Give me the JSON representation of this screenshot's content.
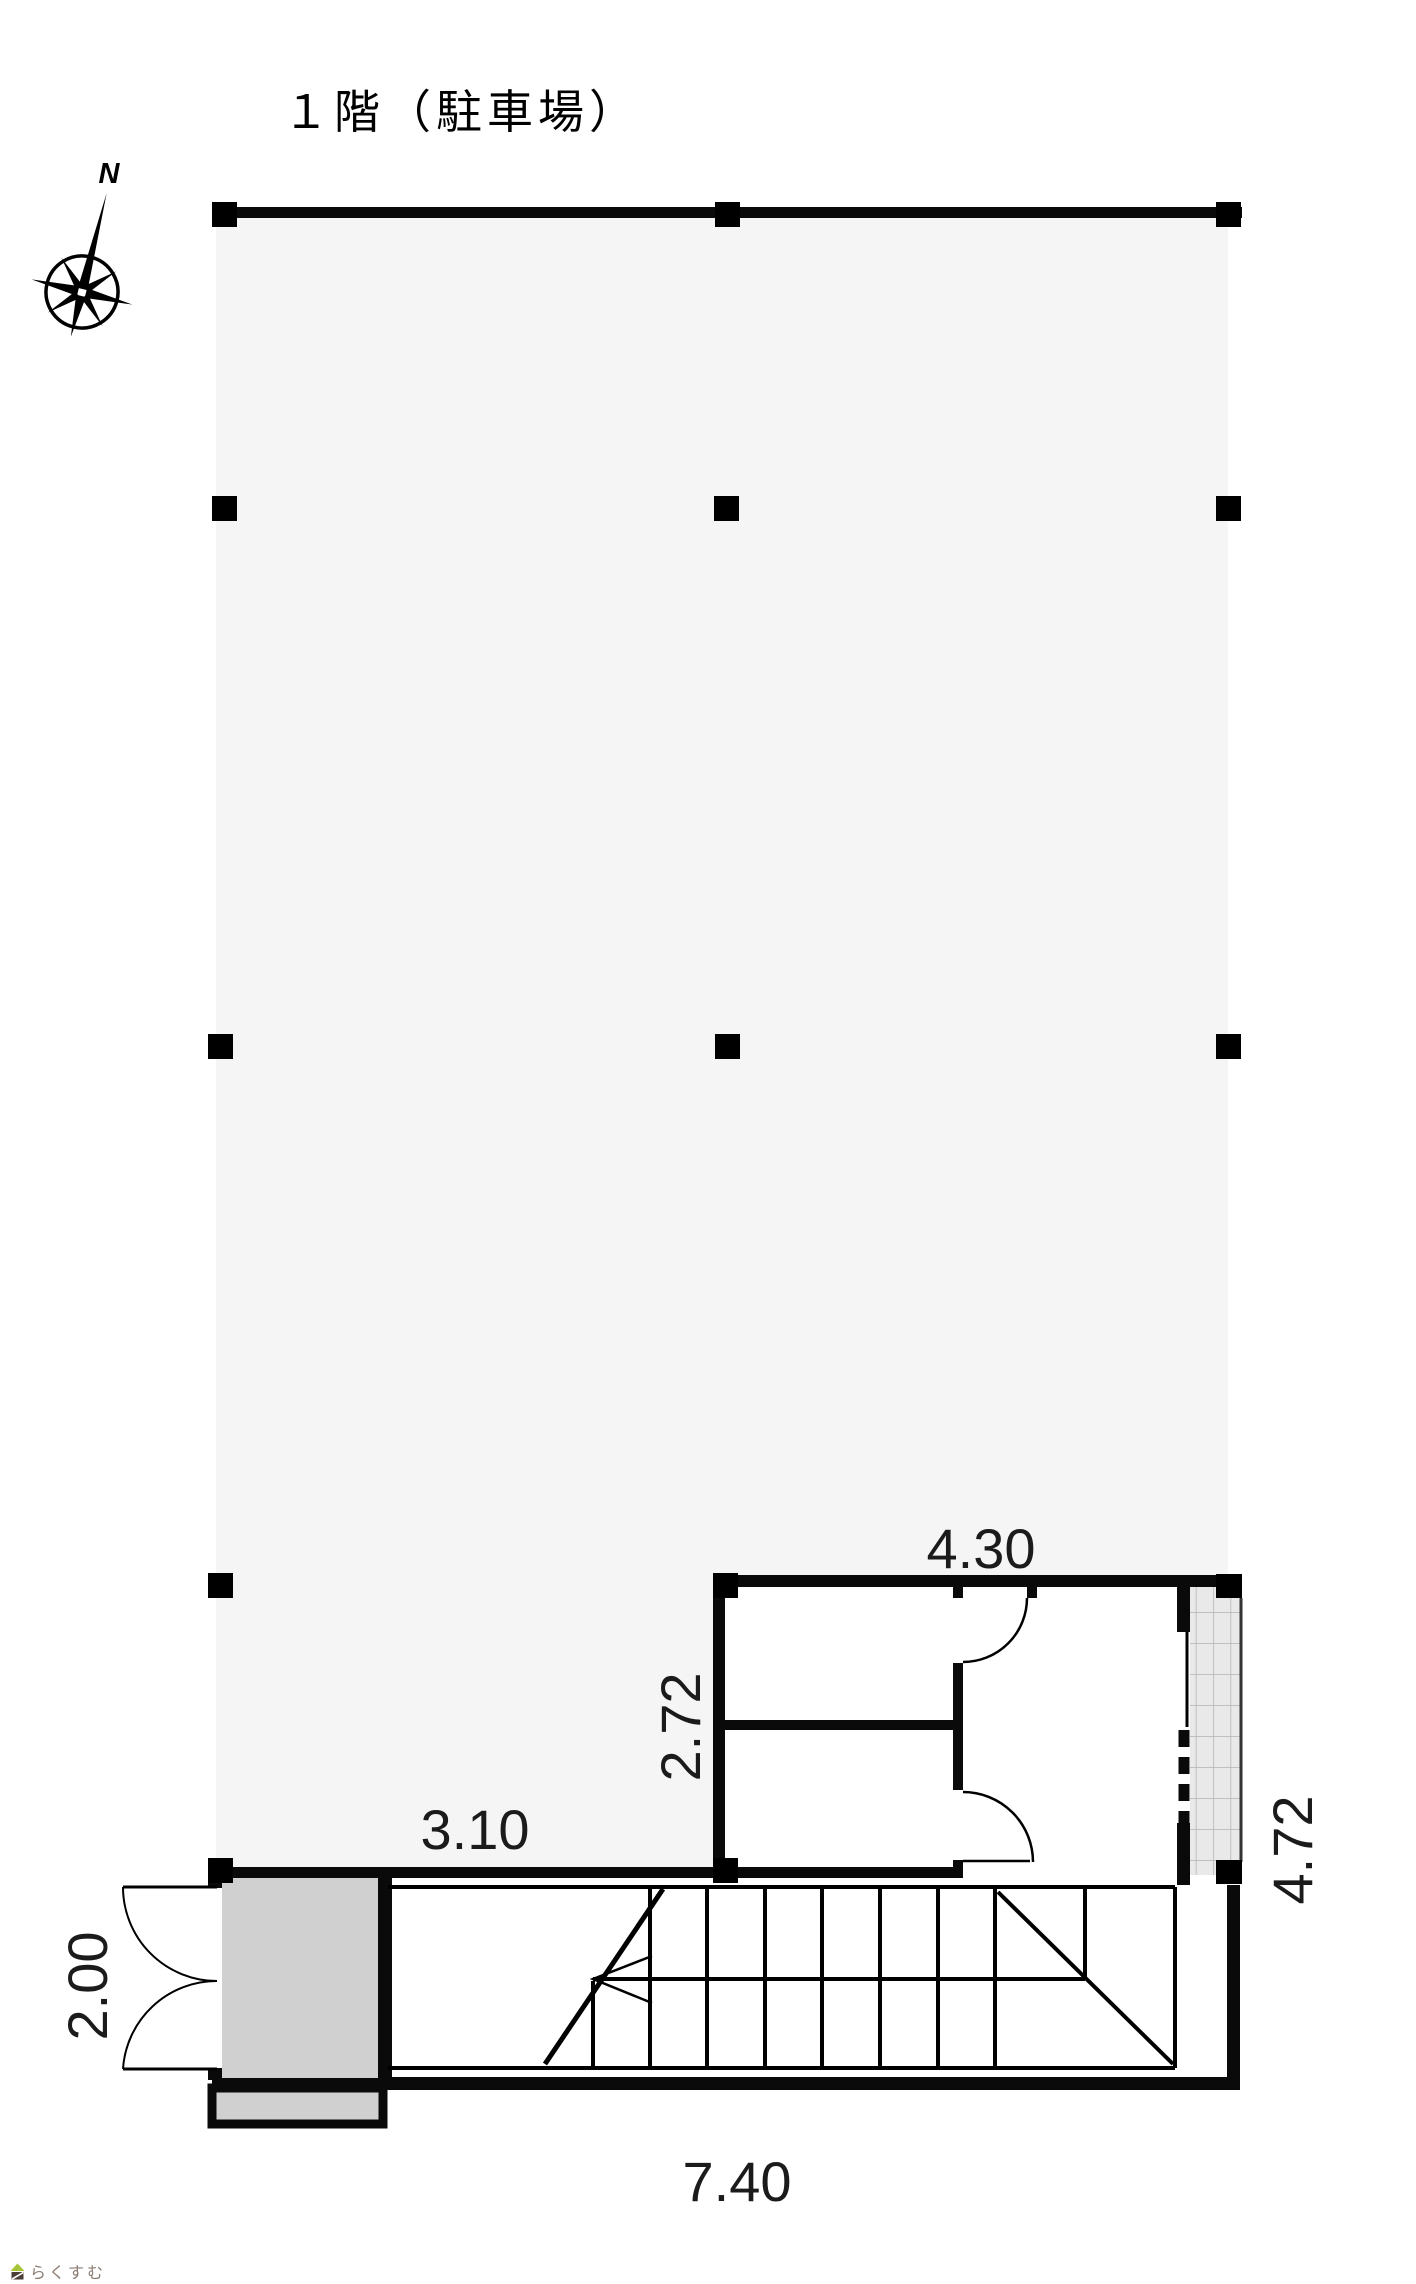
{
  "title": "１階（駐車場）",
  "compass": {
    "label": "N"
  },
  "dimensions": {
    "room_width": "4.30",
    "room_depth": "2.72",
    "left_span": "3.10",
    "entrance_depth": "2.00",
    "stair_total_width": "7.40",
    "right_total_depth": "4.72"
  },
  "logo": {
    "text": "らくすむ"
  },
  "colors": {
    "parking_fill": "#f5f5f6",
    "entrance_fill": "#d0d0d0",
    "shutter_fill": "#e9e9e9",
    "wall": "#0a0a0a",
    "dim_text": "#1b1b1b",
    "logo_green": "#a6c437",
    "logo_brown": "#4a3e36",
    "logo_text": "#8b7d74"
  }
}
